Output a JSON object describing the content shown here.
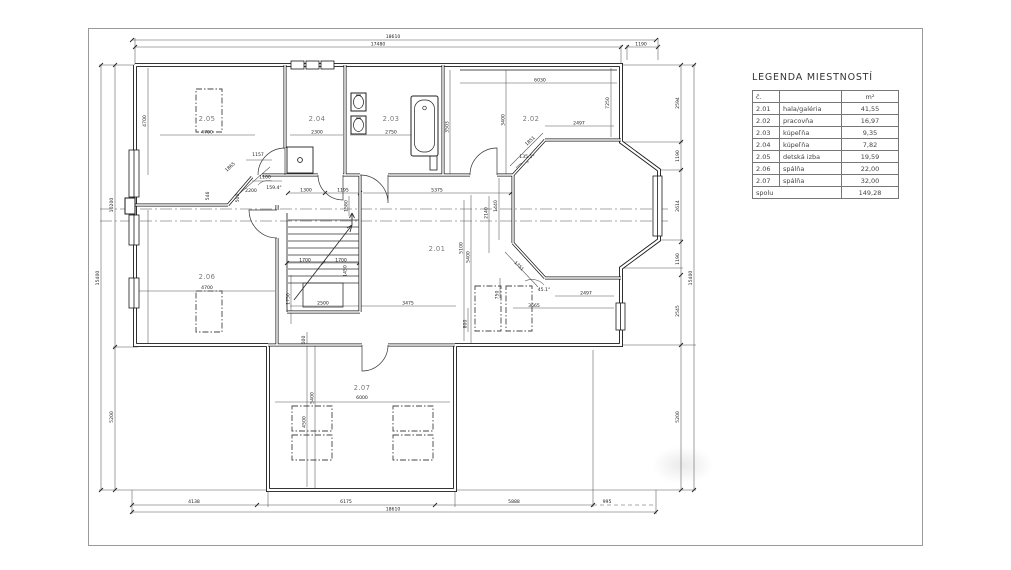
{
  "legend": {
    "title": "LEGENDA MIESTNOSTÍ",
    "col_headers": {
      "no": "č.",
      "name": "",
      "area": "m²"
    },
    "rows": [
      {
        "no": "2.01",
        "name": "hala/galéria",
        "area": "41,55"
      },
      {
        "no": "2.02",
        "name": "pracovňa",
        "area": "16,97"
      },
      {
        "no": "2.03",
        "name": "kúpeľňa",
        "area": "9,35"
      },
      {
        "no": "2.04",
        "name": "kúpeľňa",
        "area": "7,82"
      },
      {
        "no": "2.05",
        "name": "detská izba",
        "area": "19,59"
      },
      {
        "no": "2.06",
        "name": "spálňa",
        "area": "22,00"
      },
      {
        "no": "2.07",
        "name": "spálňa",
        "area": "32,00"
      }
    ],
    "total": {
      "label": "spolu",
      "area": "149,28"
    }
  },
  "rooms": {
    "r201": "2.01",
    "r202": "2.02",
    "r203": "2.03",
    "r204": "2.04",
    "r205": "2.05",
    "r206": "2.06",
    "r207": "2.07"
  },
  "dims": {
    "top_total": "18610",
    "top_main": "17480",
    "top_bay": "1190",
    "left_total": "15400",
    "left_upper": "10200",
    "left_lower": "5200",
    "right_s1": "2594",
    "right_s2": "1190",
    "right_s3": "2614",
    "right_s4": "1190",
    "right_s5": "2545",
    "right_s6": "5200",
    "right_total": "15400",
    "bot_1": "4138",
    "bot_2": "6175",
    "bot_3": "5888",
    "bot_4": "995",
    "bot_total": "18610",
    "w205": "4700",
    "w205v": "4700",
    "w204": "2300",
    "w203": "2750",
    "w202": "6030",
    "h202": "7250",
    "bay_top": "2497",
    "v3400": "3400",
    "v3503": "3503",
    "c1300": "1300",
    "c1195": "1195",
    "c5375": "5375",
    "v1580": "1580",
    "v2140": "2140",
    "a1157": "1157",
    "a1100": "1100",
    "a2200": "2200",
    "ang159": "159.4°",
    "d1865": "1865",
    "v546": "546",
    "v500": "500",
    "s1700a": "1700",
    "s1700b": "1700",
    "v1450": "1450",
    "v1750": "1750",
    "s2500": "2500",
    "s3475": "3475",
    "v5400": "5400",
    "v5100": "5100",
    "w206": "4700",
    "ang135": "135.1°",
    "d1851": "1851",
    "v1440": "1440",
    "d1751": "1751",
    "ang45": "45.1°",
    "bay_bot": "2497",
    "o3665": "3665",
    "v750": "750",
    "v800": "800",
    "v600": "600",
    "v5400b": "5400",
    "v4500": "4500",
    "w207": "6000"
  }
}
